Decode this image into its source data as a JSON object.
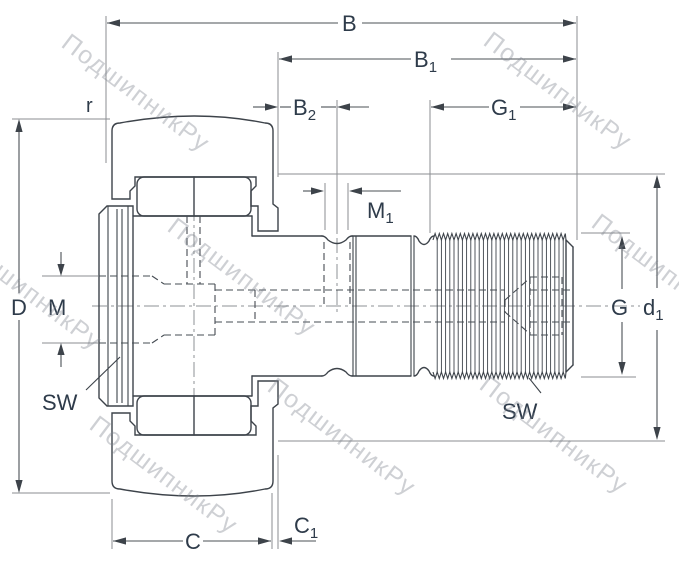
{
  "drawing": {
    "type": "technical-dimension-drawing",
    "subject": "cam follower bearing with stud, cross-section with dimension callouts"
  },
  "dims": {
    "B": {
      "base": "B",
      "sub": ""
    },
    "B1": {
      "base": "B",
      "sub": "1"
    },
    "B2": {
      "base": "B",
      "sub": "2"
    },
    "G1": {
      "base": "G",
      "sub": "1"
    },
    "M1": {
      "base": "M",
      "sub": "1"
    },
    "r": {
      "base": "r",
      "sub": ""
    },
    "D": {
      "base": "D",
      "sub": ""
    },
    "M": {
      "base": "M",
      "sub": ""
    },
    "SW_left": {
      "base": "SW",
      "sub": ""
    },
    "C": {
      "base": "C",
      "sub": ""
    },
    "C1": {
      "base": "C",
      "sub": "1"
    },
    "G": {
      "base": "G",
      "sub": ""
    },
    "d1": {
      "base": "d",
      "sub": "1"
    },
    "SW_right": {
      "base": "SW",
      "sub": ""
    }
  },
  "watermark": {
    "text": "ПодшипникРу"
  },
  "colors": {
    "ring_fill": "#bdcfe8",
    "object_line": "#3d434a",
    "dimension_line": "#4b5056",
    "extension_line": "#8b8e92",
    "label": "#2e3b4a",
    "watermark": "#7d848e",
    "background": "#ffffff"
  }
}
